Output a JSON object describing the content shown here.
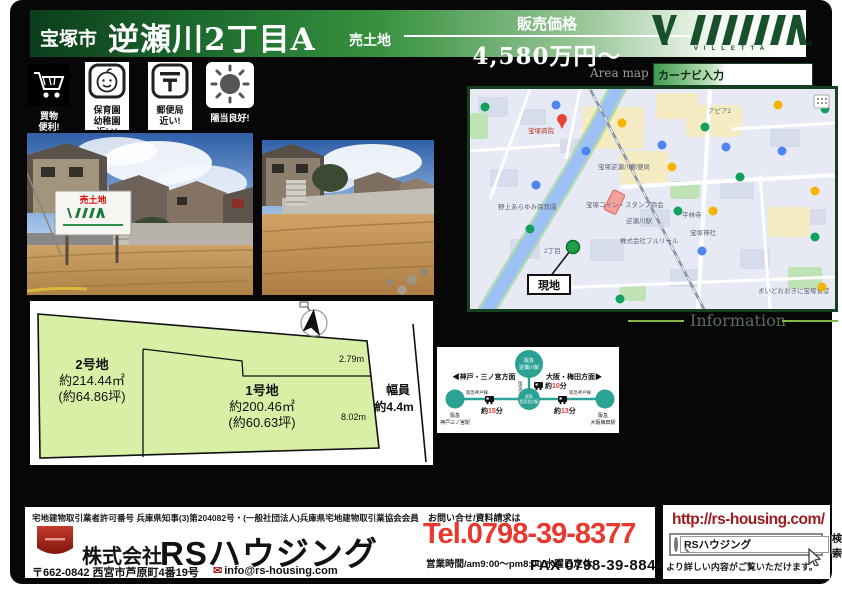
{
  "header": {
    "city": "宝塚市",
    "title": "逆瀬川2丁目A",
    "sale_type": "売土地",
    "price_label": "販売価格",
    "price": "4,580万円～"
  },
  "brand": {
    "name": "VILLETTA",
    "registered": "®"
  },
  "area_map": {
    "label": "Area map",
    "navi_label": "カーナビ入力"
  },
  "badges": [
    {
      "icon": "cart-icon",
      "lines": [
        "買物",
        "便利!"
      ]
    },
    {
      "icon": "baby-icon",
      "lines": [
        "保育園",
        "幼稚園",
        "近い!"
      ]
    },
    {
      "icon": "post-icon",
      "lines": [
        "郵便局",
        "近い!"
      ]
    },
    {
      "icon": "sun-icon",
      "lines": [
        "陽当良好!"
      ]
    }
  ],
  "photos": {
    "sign_text": "売土地"
  },
  "map": {
    "site_label": "現地",
    "poi": [
      {
        "label": "宝塚病院"
      },
      {
        "label": "逆瀬川駅"
      },
      {
        "label": "アピア2"
      },
      {
        "label": "宝塚逆瀬川郵便局"
      },
      {
        "label": "宝塚コイン・スタンプ商会"
      },
      {
        "label": "株式会社フルリール"
      },
      {
        "label": "平林寺"
      },
      {
        "label": "宝塚神社"
      },
      {
        "label": "野上あらゆみ保育園"
      },
      {
        "label": "2丁目"
      },
      {
        "label": "まいどおおきに宝塚食堂"
      }
    ]
  },
  "info": {
    "title": "Information"
  },
  "route": {
    "top_station": [
      "阪急",
      "逆瀬川駅"
    ],
    "center_station": [
      "阪急",
      "西宮北口駅"
    ],
    "left_station": [
      "阪急",
      "神戸三ノ宮駅"
    ],
    "right_station": [
      "阪急",
      "大阪梅田駅"
    ],
    "left_direction": "◀神戸・三ノ宮方面",
    "right_direction": "大阪・梅田方面▶",
    "imazu_line": "阪急今津線",
    "kobe_line_left": "阪急神戸線",
    "kobe_line_right": "阪急神戸線",
    "times": [
      {
        "pre": "約",
        "num": "10",
        "suf": "分"
      },
      {
        "pre": "約",
        "num": "15",
        "suf": "分"
      },
      {
        "pre": "約",
        "num": "13",
        "suf": "分"
      }
    ]
  },
  "plot": {
    "lot2_name": "2号地",
    "lot2_area": "約214.44㎡",
    "lot2_tsubo": "(約64.86坪)",
    "lot1_name": "1号地",
    "lot1_area": "約200.46㎡",
    "lot1_tsubo": "(約60.63坪)",
    "dim_top": "2.79m",
    "dim_right": "8.02m",
    "road_label_1": "幅員",
    "road_label_2": "約4.4m"
  },
  "footer": {
    "license": "宅地建物取引業者許可番号 兵庫県知事(3)第204082号・(一般社団法人)兵庫県宅地建物取引業協会会員",
    "company_prefix": "株式会社",
    "company_name": "RSハウジング",
    "postal_address": "〒662-0842 西宮市芦原町4番19号",
    "email": "info@rs-housing.com",
    "mail_icon": "✉",
    "contact_label": "お問い合せ/資料請求は",
    "tel": "Tel.0798-39-8377",
    "hours": "営業時間/am9:00～pm8:00 水曜日定休",
    "fax": "FAX 0798-39-8844",
    "url": "http://rs-housing.com/",
    "search_value": "RSハウジング",
    "search_button": "検索",
    "search_note": "より詳しい内容がご覧いただけます。"
  },
  "colors": {
    "accent_red": "#e8382f",
    "brand_green": "#17502a",
    "lot_green": "#d9efa5",
    "route_teal": "#2ba293"
  }
}
